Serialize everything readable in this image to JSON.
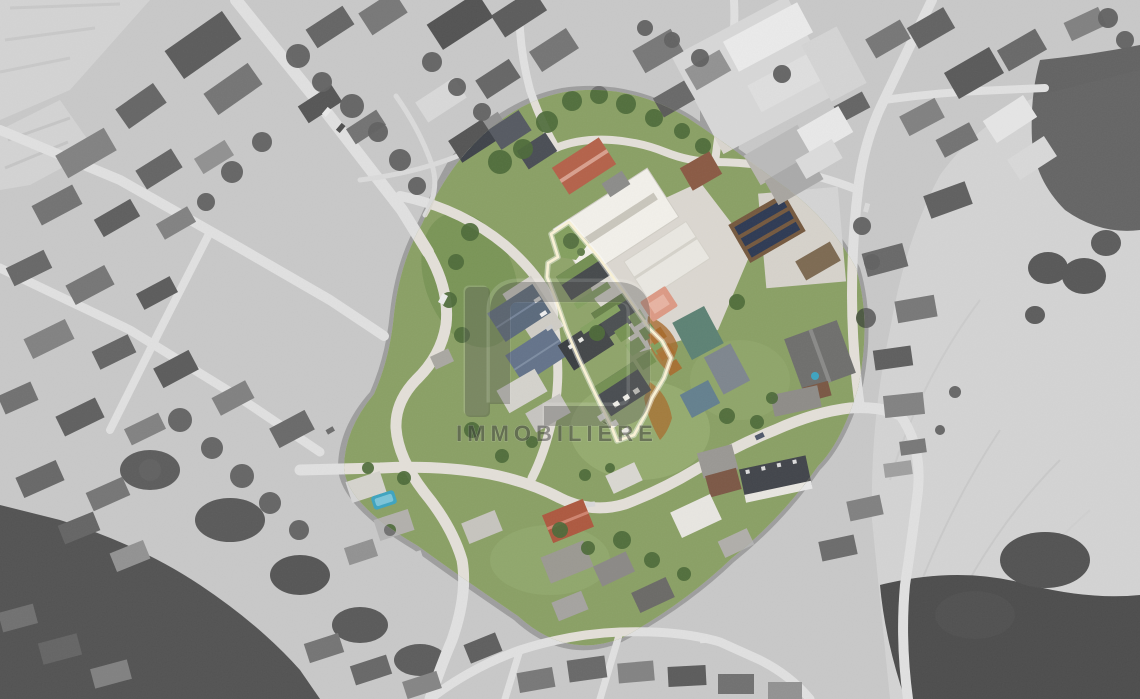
{
  "meta": {
    "kind": "real-estate aerial photograph",
    "width_px": 1140,
    "height_px": 699,
    "effect": "village center in color, surroundings desaturated to grayscale"
  },
  "watermark": {
    "text": "IMMOBILIÈRE",
    "logo": "immobiliere-logo-glyph"
  },
  "colors": {
    "property_outline": "#FAF2D6",
    "highlight_plot_orange": "#A86C2E",
    "lawn_green": "#8AA065",
    "tree_green": "#4E6B3A",
    "pool_blue": "#3EA4C0",
    "teal_roof": "#5D8274",
    "red_roof": "#AD5940",
    "solar_panel_blue": "#2E3A54",
    "road_gray": "#E3DFD8",
    "field_tan": "#D7D1C5",
    "watermark_gray": "#3F3F3F"
  }
}
